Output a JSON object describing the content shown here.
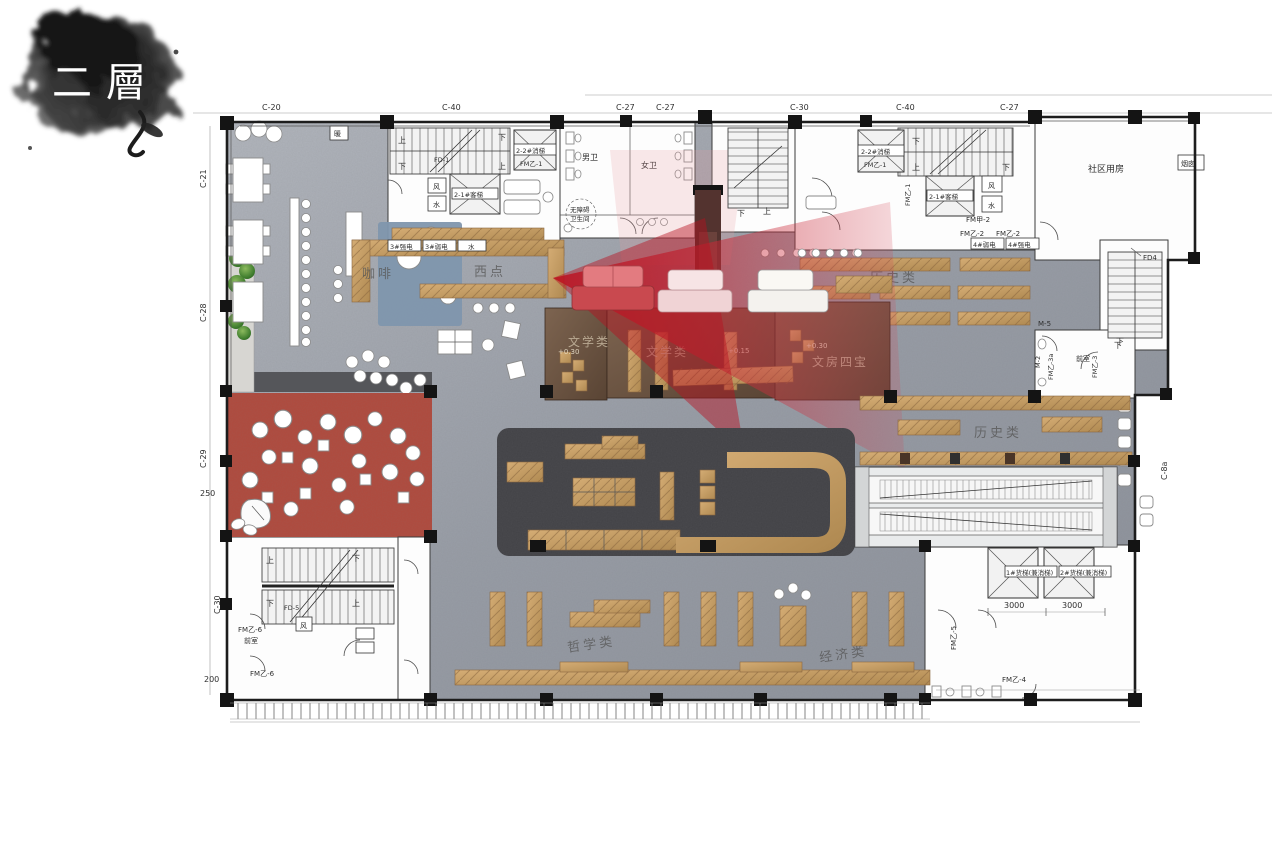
{
  "meta": {
    "floor_title": "二層"
  },
  "palette": {
    "page_bg": "#ffffff",
    "ink": "#1b1b1b",
    "floor_gray": "#9aa0a8",
    "walkway_dark": "#55565a",
    "wood": "#c9a369",
    "dark_wood": "#6b5547",
    "corridor_wood": "#53332f",
    "red_carpet": "#b04a3d",
    "highlight_red": "#cf2231",
    "rug_dark": "#424246",
    "blue_rug": "#8096ad",
    "plant_green": "#4e8a33"
  },
  "grid": {
    "top": [
      "C-20",
      "C-40",
      "C-27",
      "C-27",
      "C-30",
      "C-40",
      "C-27"
    ],
    "left": [
      "C-21",
      "C-28",
      "C-29",
      "C-30"
    ],
    "right": [
      "C-26",
      "C-8a",
      "C-9a"
    ],
    "dims": {
      "left_upper": "250",
      "left_lower": "200",
      "freight_a": "3000",
      "freight_b": "3000"
    }
  },
  "zones": {
    "cafe": "咖啡",
    "pastry": "西点",
    "literature": "文学类",
    "four_treasures": "文房四宝",
    "history": "历史类",
    "philosophy": "哲学类",
    "economics": "经济类",
    "community_room": "社区用房"
  },
  "rooms": {
    "mens_wc": "男卫",
    "womens_wc": "女卫",
    "accessible_wc_l1": "无障碍",
    "accessible_wc_l2": "卫生间",
    "anteroom": "前室"
  },
  "mech": {
    "heating": "暖",
    "air": "风",
    "water": "水",
    "strong_3": "3#强电",
    "weak_3": "3#弱电",
    "weak_4": "4#弱电",
    "strong_4": "4#强电",
    "chimney": "烟囱"
  },
  "lifts": {
    "passenger": "2-1#客梯",
    "fire": "2-2#消梯",
    "freight_1": "1#货梯(兼消梯)",
    "freight_2": "2#货梯(兼消梯)"
  },
  "fire_doors": {
    "fm_yi_1": "FM乙-1",
    "fm_jia_2": "FM甲-2",
    "fm_yi_2": "FM乙-2",
    "fm_yi_3": "FM乙-3",
    "fm_yi_3a": "FM乙-3a",
    "fm_yi_4": "FM乙-4",
    "fm_yi_5": "FM乙-5",
    "fm_yi_6": "FM乙-6",
    "m_2": "M-2",
    "m_5": "M-5",
    "fd_1": "FD-1",
    "fd_4": "FD4",
    "fd_5": "FD-5"
  },
  "stairs": {
    "up": "上",
    "down": "下"
  },
  "levels": {
    "plus_030": "+0.30",
    "plus_015": "+0.15"
  }
}
